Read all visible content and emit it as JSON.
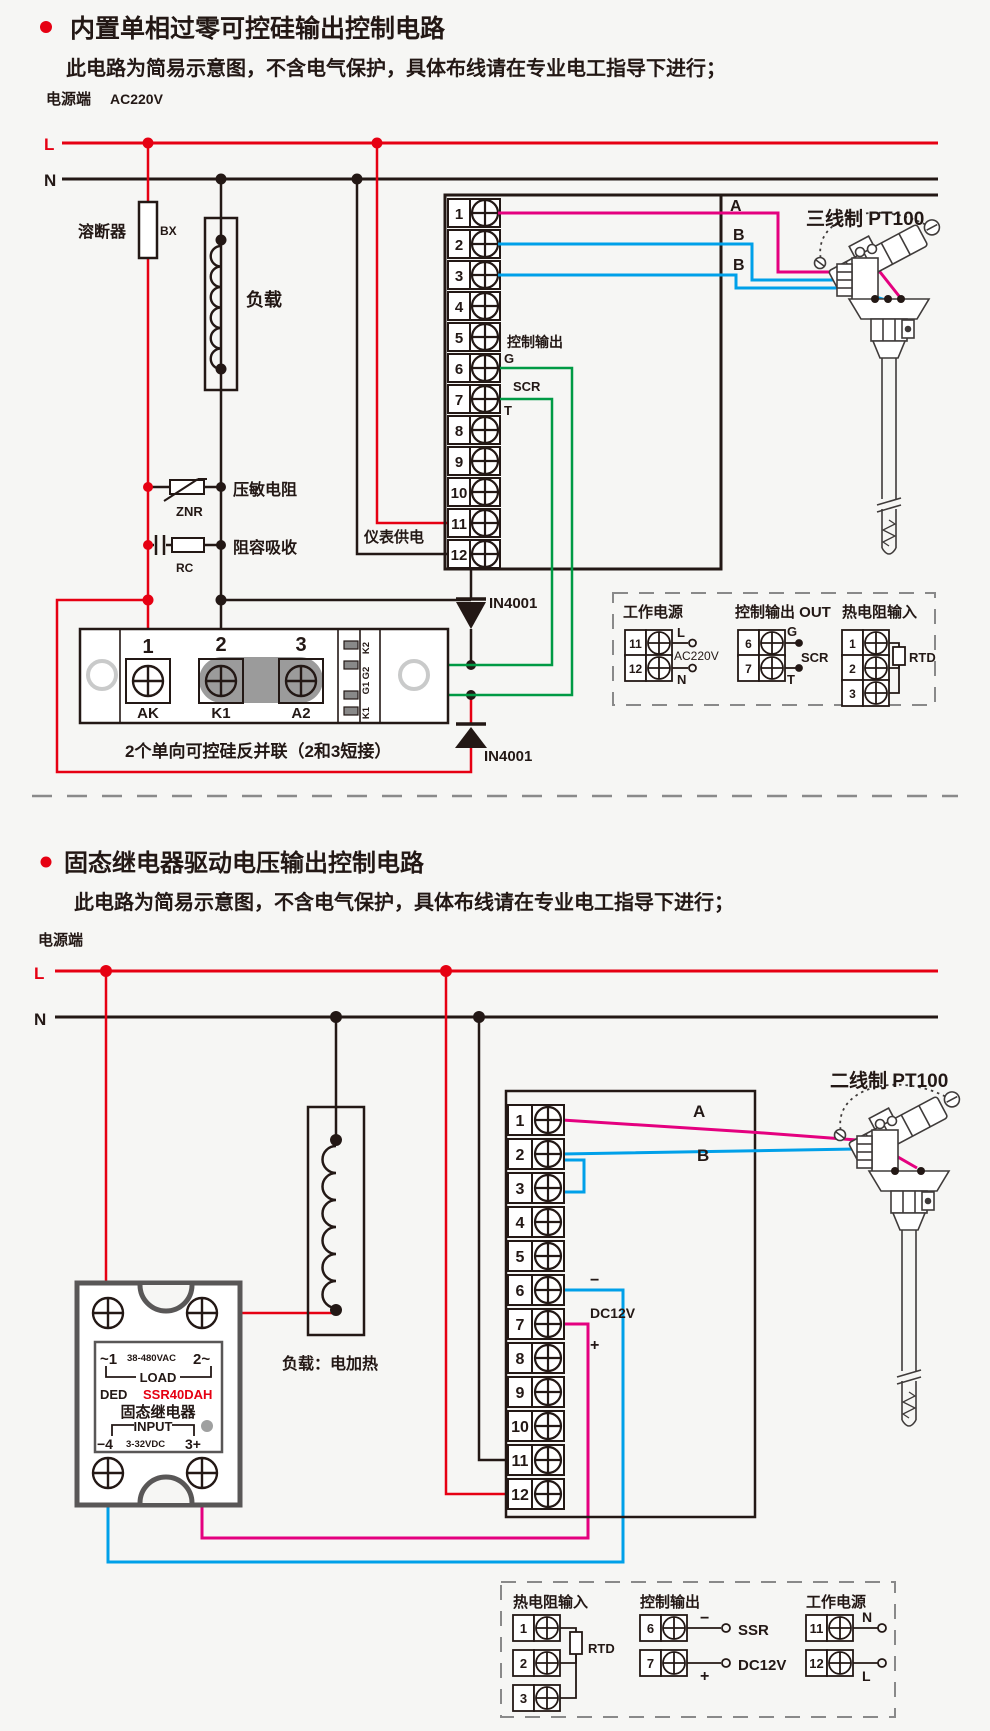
{
  "s1": {
    "title": "内置单相过零可控硅输出控制电路",
    "subtitle": "此电路为简易示意图，不含电气保护，具体布线请在专业电工指导下进行；",
    "power_label": "电源端",
    "power_voltage": "AC220V",
    "l": "L",
    "n": "N",
    "fuse": "溶断器",
    "fuse_code": "BX",
    "load": "负载",
    "varistor": "压敏电阻",
    "varistor_code": "ZNR",
    "rc": "阻容吸收",
    "rc_code": "RC",
    "meter_supply": "仪表供电",
    "control_output": "控制输出",
    "g": "G",
    "scr": "SCR",
    "t": "T",
    "a": "A",
    "b1": "B",
    "b2": "B",
    "sensor": "三线制 PT100",
    "diode": "IN4001",
    "terminals": [
      "1",
      "2",
      "3",
      "4",
      "5",
      "6",
      "7",
      "8",
      "9",
      "10",
      "11",
      "12"
    ],
    "module": {
      "n1": "1",
      "n2": "2",
      "n3": "3",
      "ak": "AK",
      "k1": "K1",
      "a2": "A2",
      "sk2": "K2",
      "sg2": "G2",
      "sg1": "G1",
      "sk1": "K1",
      "caption": "2个单向可控硅反并联（2和3短接）"
    },
    "legend": {
      "power_title": "工作电源",
      "t11": "11",
      "t12": "12",
      "l": "L",
      "n": "N",
      "volt": "AC220V",
      "out_title": "控制输出 OUT",
      "t6": "6",
      "t7": "7",
      "g": "G",
      "t": "T",
      "scr": "SCR",
      "rtd_title": "热电阻输入",
      "t1": "1",
      "t2": "2",
      "t3": "3",
      "rtd": "RTD"
    }
  },
  "s2": {
    "title": "固态继电器驱动电压输出控制电路",
    "subtitle": "此电路为简易示意图，不含电气保护，具体布线请在专业电工指导下进行；",
    "power_label": "电源端",
    "l": "L",
    "n": "N",
    "load": "负载：电加热",
    "sensor": "二线制 PT100",
    "a": "A",
    "b": "B",
    "minus": "−",
    "plus": "+",
    "dc12v": "DC12V",
    "terminals": [
      "1",
      "2",
      "3",
      "4",
      "5",
      "6",
      "7",
      "8",
      "9",
      "10",
      "11",
      "12"
    ],
    "ssr": {
      "ac1": "~1",
      "ac": "38-480VAC",
      "ac2": "2~",
      "load": "LOAD",
      "ded": "DED",
      "model": "SSR40DAH",
      "name": "固态继电器",
      "input": "INPUT",
      "in1": "−4",
      "vdc": "3-32VDC",
      "in2": "3+"
    },
    "legend": {
      "rtd_title": "热电阻输入",
      "t1": "1",
      "t2": "2",
      "t3": "3",
      "rtd": "RTD",
      "out_title": "控制输出",
      "t6": "6",
      "t7": "7",
      "minus": "−",
      "plus": "+",
      "ssr": "SSR",
      "dc12v": "DC12V",
      "power_title": "工作电源",
      "t11": "11",
      "t12": "12",
      "n": "N",
      "l": "L"
    }
  }
}
